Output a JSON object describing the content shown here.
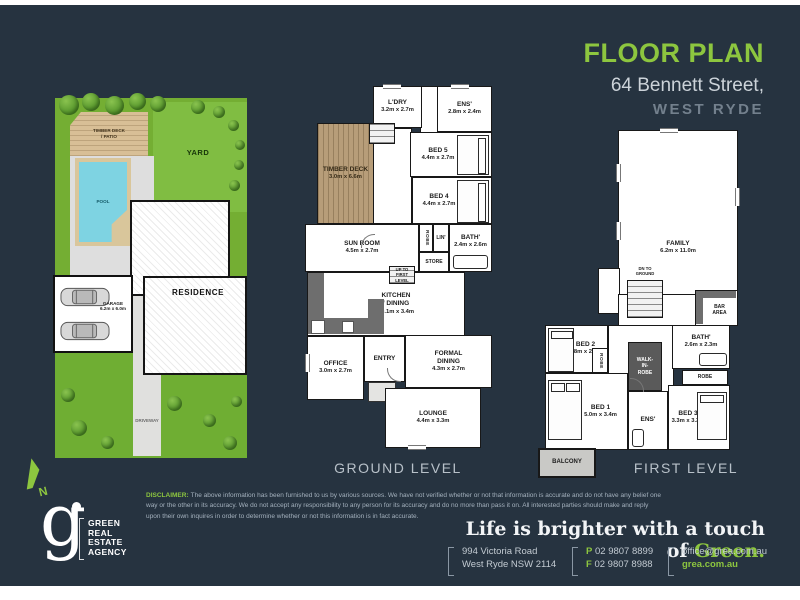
{
  "colors": {
    "background": "#263340",
    "accent_green": "#8dc63f",
    "heading_gray": "#ccd3d9",
    "subheading_gray": "#73808d"
  },
  "header": {
    "title": "FLOOR PLAN",
    "address": "64 Bennett Street,",
    "suburb": "WEST RYDE"
  },
  "site_plan": {
    "yard": "YARD",
    "timber_deck": "TIMBER DECK\n/ PATIO",
    "pool": "POOL",
    "residence": "RESIDENCE",
    "garage": "GARAGE\n6.2m x 6.0m",
    "driveway": "DRIVEWAY"
  },
  "compass": {
    "north": "N"
  },
  "ground_level": {
    "caption": "GROUND LEVEL",
    "rooms": {
      "ldry": {
        "name": "L'DRY",
        "dims": "3.2m x 2.7m"
      },
      "ens": {
        "name": "ENS'",
        "dims": "2.8m x 2.4m"
      },
      "bed5": {
        "name": "BED 5",
        "dims": "4.4m x 2.7m"
      },
      "bed4": {
        "name": "BED 4",
        "dims": "4.4m x 2.7m"
      },
      "timber_deck": {
        "name": "TIMBER DECK",
        "dims": "3.0m x 6.6m"
      },
      "sun_room": {
        "name": "SUN ROOM",
        "dims": "4.5m x 2.7m"
      },
      "robe": {
        "name": "ROBE"
      },
      "lin": {
        "name": "LIN'"
      },
      "store": {
        "name": "STORE"
      },
      "bath": {
        "name": "BATH'",
        "dims": "2.4m x 2.6m"
      },
      "stairs": {
        "name": "UP TO\nFIRST LEVEL"
      },
      "kitchen": {
        "name": "KITCHEN\n/ DINING",
        "dims": "10.1m x 3.4m"
      },
      "office": {
        "name": "OFFICE",
        "dims": "3.0m x 2.7m"
      },
      "entry": {
        "name": "ENTRY"
      },
      "formal_dining": {
        "name": "FORMAL\nDINING",
        "dims": "4.3m x 2.7m"
      },
      "lounge": {
        "name": "LOUNGE",
        "dims": "4.4m x 3.3m"
      }
    }
  },
  "first_level": {
    "caption": "FIRST LEVEL",
    "rooms": {
      "family": {
        "name": "FAMILY",
        "dims": "6.2m x 11.0m"
      },
      "stairs": {
        "name": "DN TO\nGROUND"
      },
      "bar": {
        "name": "BAR\nAREA"
      },
      "bed2": {
        "name": "BED 2",
        "dims": "3.8m x 2.7m"
      },
      "robe_side": {
        "name": "ROBE"
      },
      "walk_in_robe": {
        "name": "WALK-\nIN-\nROBE"
      },
      "bath": {
        "name": "BATH'",
        "dims": "2.6m x 2.3m"
      },
      "robe_front": {
        "name": "ROBE"
      },
      "bed1": {
        "name": "BED 1",
        "dims": "5.0m x 3.4m"
      },
      "ens": {
        "name": "ENS'"
      },
      "bed3": {
        "name": "BED 3",
        "dims": "3.3m x 3.3m"
      },
      "balcony": {
        "name": "BALCONY"
      }
    }
  },
  "footer": {
    "logo": {
      "letter": "g",
      "lines": [
        "GREEN",
        "REAL",
        "ESTATE",
        "AGENCY"
      ]
    },
    "disclaimer_label": "DISCLAIMER:",
    "disclaimer_text": "The above information has been furnished to us by various sources. We have not verified whether or not that information is accurate and do not have any belief one way or the other in its accuracy. We do not accept any responsibility to any person for its accuracy and do no more than pass it on. All interested parties should make and reply upon their own inquires in order to determine whether or not this information is in fact accurate.",
    "tagline_prefix": "Life is brighter with a touch of ",
    "tagline_highlight": "Green.",
    "contact": {
      "address_line1": "994 Victoria Road",
      "address_line2": "West Ryde NSW 2114",
      "phone_label": "P",
      "phone": "02 9807 8899",
      "fax_label": "F",
      "fax": "02 9807 8988",
      "email": "office@grea.com.au",
      "website": "grea.com.au"
    }
  }
}
